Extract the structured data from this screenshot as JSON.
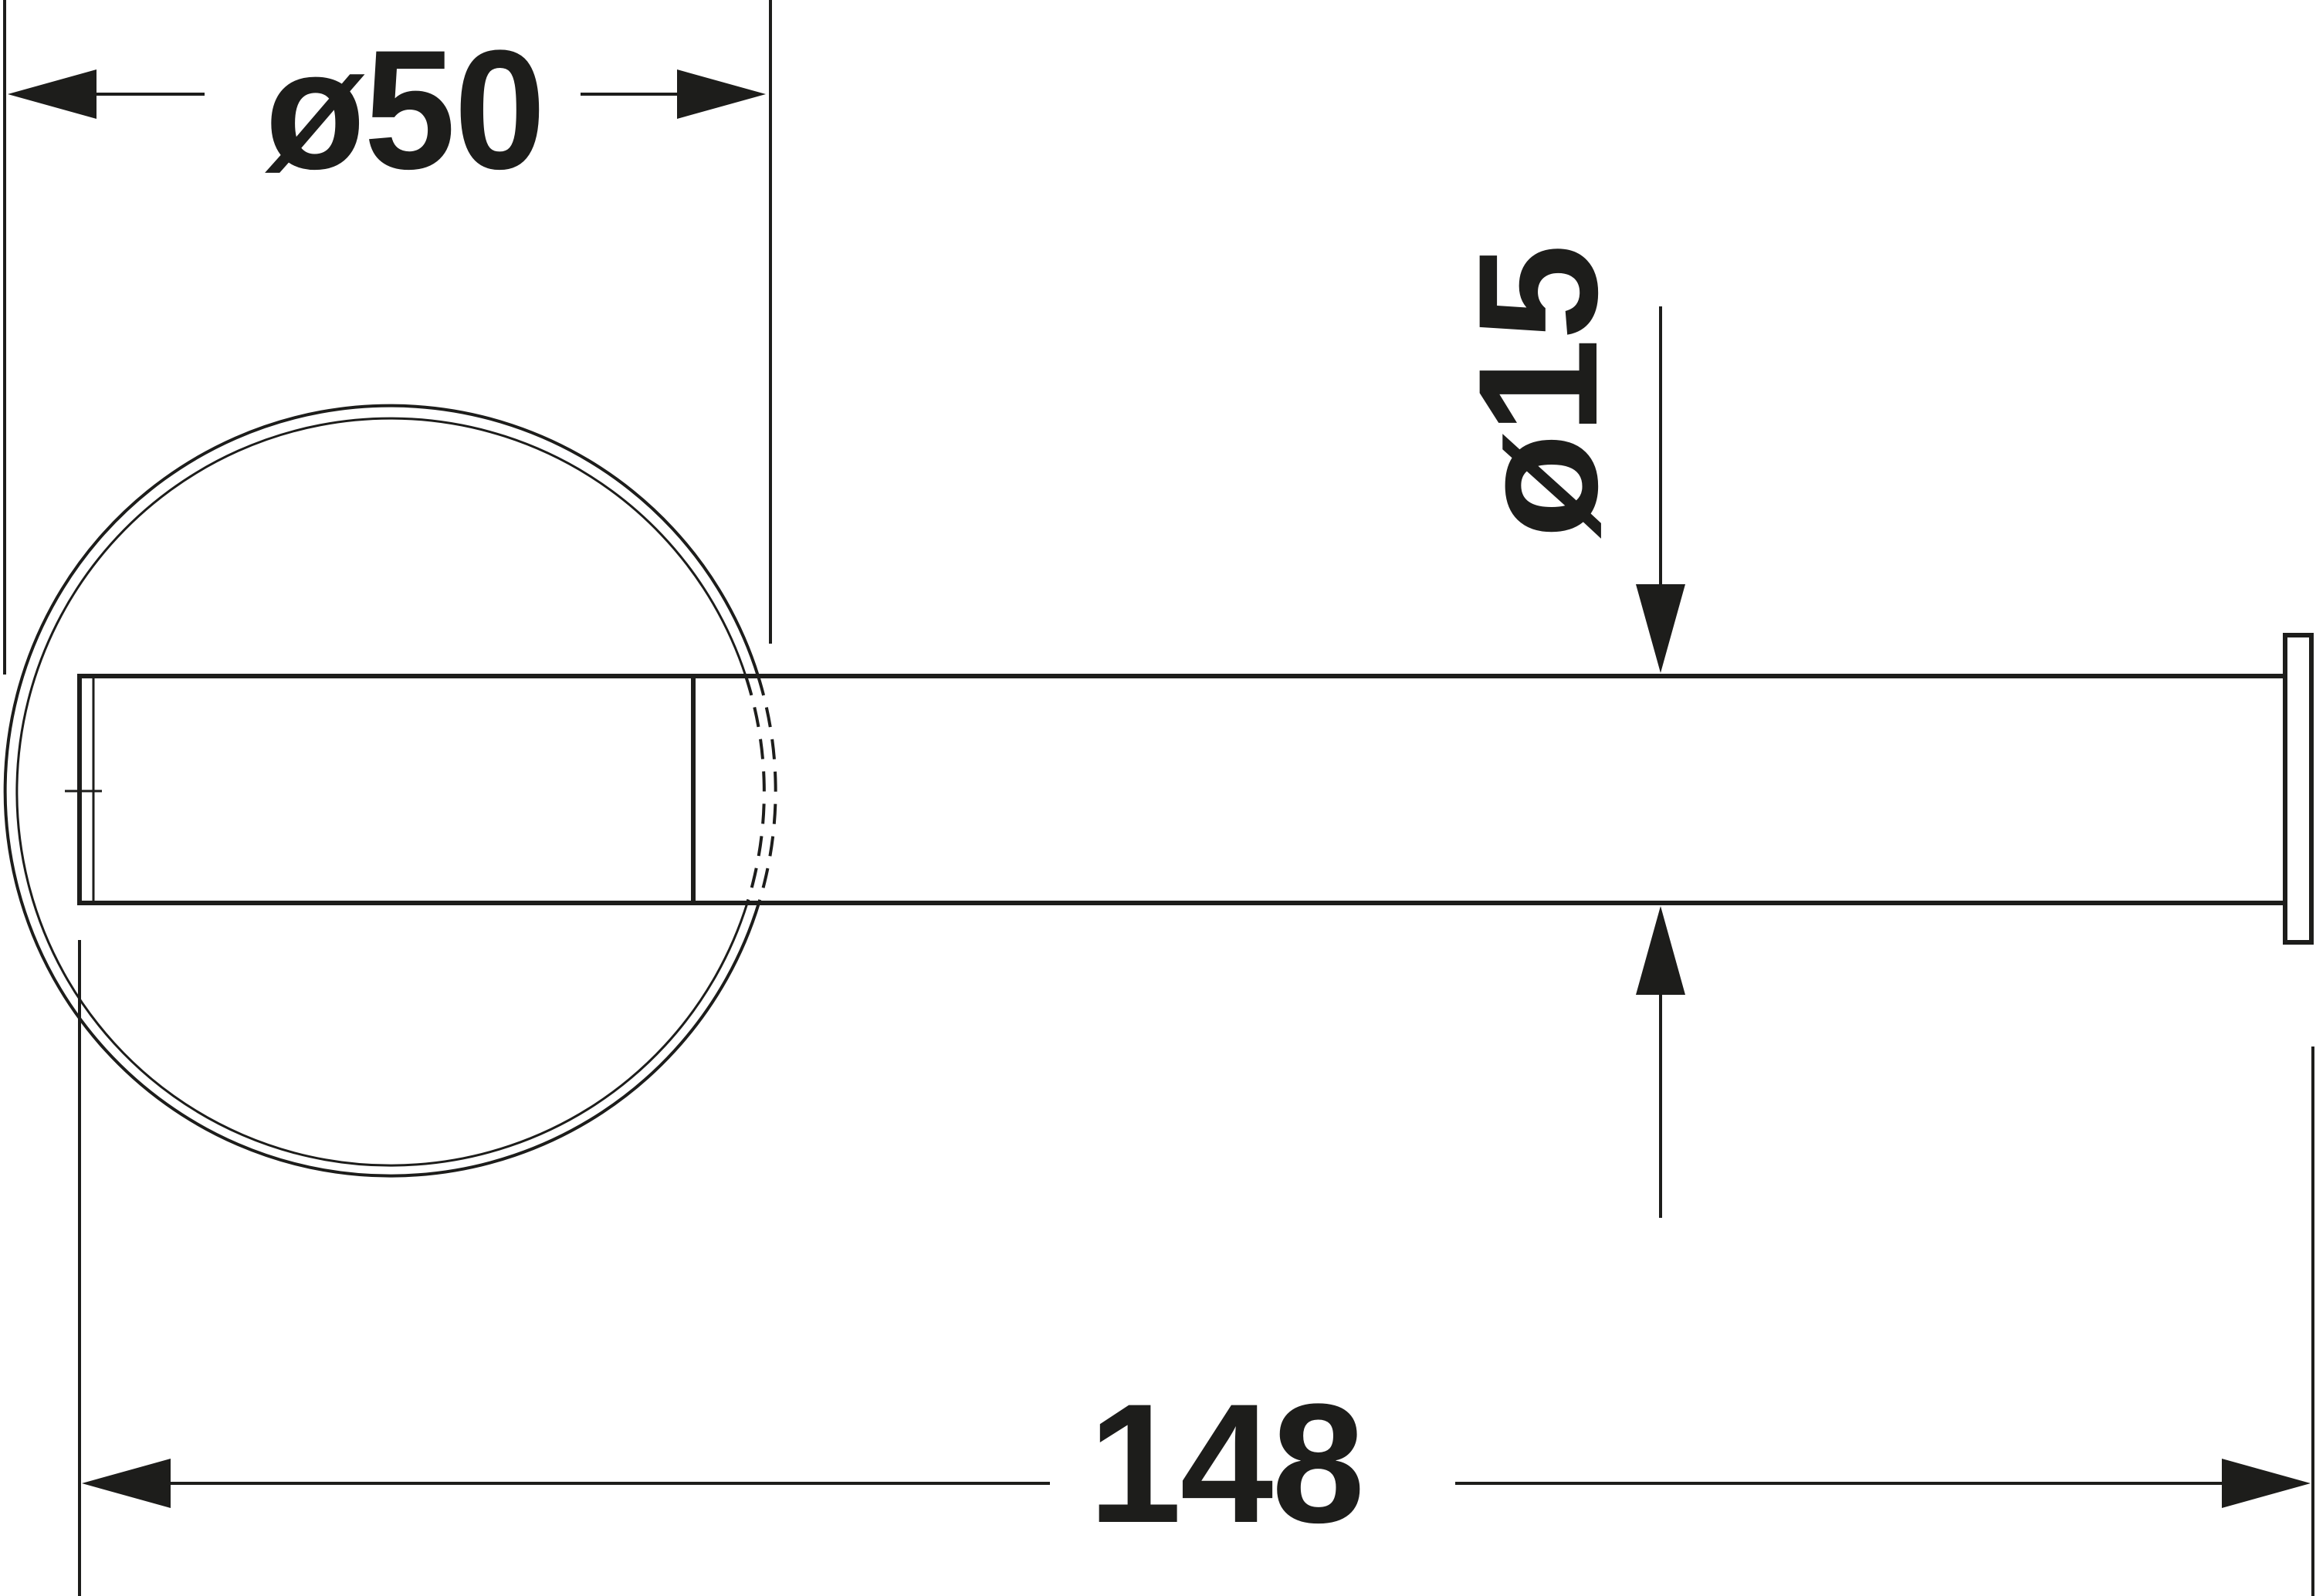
{
  "diagram": {
    "kind": "technical-dimension-drawing",
    "labels": {
      "plate_diameter": "ø50",
      "rod_diameter": "ø15",
      "length": "148"
    },
    "values": {
      "plate_diameter": 50,
      "rod_diameter": 15,
      "length": 148
    },
    "colors": {
      "line": "#1d1d1b",
      "background": "#ffffff"
    }
  }
}
